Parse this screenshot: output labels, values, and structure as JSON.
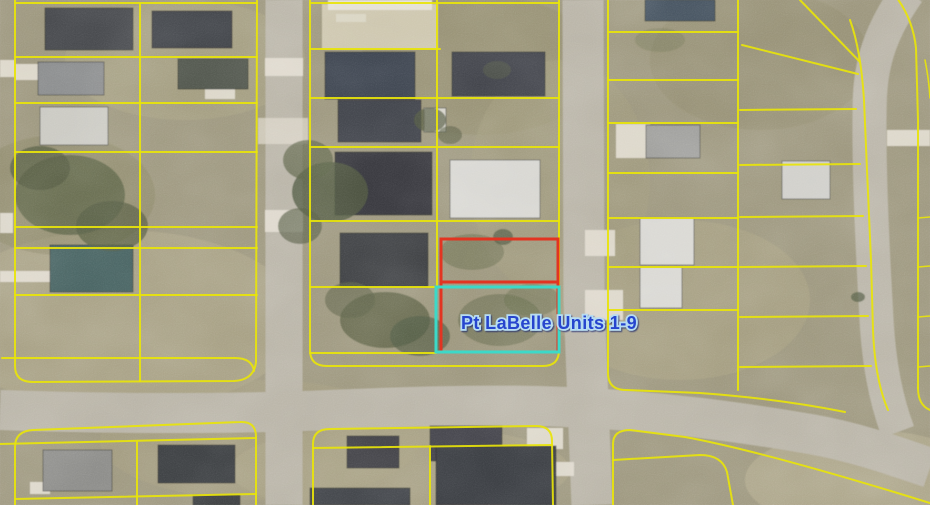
{
  "map": {
    "label": {
      "text": "Pt LaBelle Units 1-9",
      "x": 549,
      "y": 329
    },
    "colors": {
      "parcel_line_yellow": "#e8e40a",
      "highlight_red": "#e23421",
      "highlight_cyan": "#3cd9c8",
      "label_blue": "#2745ce",
      "label_halo": "#b7dcf2",
      "road_gray": "#b8b3a6",
      "ground_tan": "#9b957b",
      "driveway_light": "#ded9cc",
      "tree_olive": "#5a6146"
    },
    "highlights": [
      {
        "name": "red-outlined-lots",
        "color_ref": "highlight_red"
      },
      {
        "name": "cyan-outlined-lot",
        "color_ref": "highlight_cyan"
      }
    ],
    "features": {
      "ground_patches": [
        [
          120,
          320,
          180,
          90,
          "#b2aa8c",
          0.5
        ],
        [
          680,
          300,
          130,
          80,
          "#aca584",
          0.45
        ],
        [
          865,
          480,
          120,
          50,
          "#c0b89a",
          0.4
        ],
        [
          60,
          195,
          95,
          60,
          "#8a8566",
          0.5
        ],
        [
          480,
          65,
          120,
          70,
          "#928b6c",
          0.5
        ],
        [
          185,
          60,
          120,
          60,
          "#aaa385",
          0.45
        ],
        [
          760,
          60,
          110,
          70,
          "#8f8a6b",
          0.4
        ],
        [
          400,
          470,
          170,
          45,
          "#b1a98b",
          0.4
        ],
        [
          560,
          180,
          90,
          120,
          "#a29b7d",
          0.5
        ],
        [
          260,
          440,
          160,
          60,
          "#a8a083",
          0.4
        ]
      ],
      "bare_ground": [
        [
          322,
          4,
          116,
          45,
          "#cdc6ae",
          1
        ],
        [
          328,
          0,
          104,
          10,
          "#e3e0d4",
          1
        ],
        [
          336,
          14,
          30,
          8,
          "#dcd8c8",
          0.8
        ]
      ],
      "roads": [
        {
          "d": "M284,0 L284,505",
          "w": 37
        },
        {
          "d": "M583,0 L584,300 L592,505",
          "w": 41
        },
        {
          "d": "M0,410 C140,415 260,413 330,410 C420,406 500,404 566,407 C660,411 740,422 810,434 C856,442 895,456 930,468",
          "w": 40
        },
        {
          "d": "M908,-8 C885,25 872,55 870,95 C868,150 872,240 876,310 C878,355 884,395 898,432",
          "w": 34
        }
      ],
      "driveways": [
        [
          0,
          60,
          15,
          17
        ],
        [
          0,
          213,
          13,
          20
        ],
        [
          265,
          58,
          38,
          18
        ],
        [
          265,
          210,
          38,
          22
        ],
        [
          258,
          118,
          50,
          26,
          0.7
        ],
        [
          585,
          230,
          30,
          26
        ],
        [
          585,
          290,
          38,
          30
        ],
        [
          616,
          124,
          34,
          34
        ],
        [
          887,
          130,
          43,
          16
        ],
        [
          527,
          428,
          36,
          21
        ],
        [
          30,
          482,
          20,
          12
        ],
        [
          548,
          462,
          26,
          14
        ],
        [
          15,
          64,
          24,
          16
        ],
        [
          0,
          271,
          52,
          11
        ],
        [
          205,
          88,
          30,
          11
        ]
      ],
      "houses": [
        [
          45,
          8,
          88,
          42,
          "#45464b"
        ],
        [
          152,
          11,
          80,
          37,
          "#3d3f44"
        ],
        [
          38,
          62,
          66,
          33,
          "#87898a"
        ],
        [
          178,
          59,
          70,
          30,
          "#51564e"
        ],
        [
          40,
          107,
          68,
          38,
          "#c9c8c1"
        ],
        [
          50,
          245,
          83,
          47,
          "#44605e"
        ],
        [
          325,
          52,
          90,
          47,
          "#3b424e"
        ],
        [
          452,
          52,
          93,
          44,
          "#404249"
        ],
        [
          338,
          100,
          83,
          42,
          "#3e4046"
        ],
        [
          424,
          108,
          22,
          24,
          "#d5d3c9"
        ],
        [
          335,
          152,
          97,
          63,
          "#34353a"
        ],
        [
          450,
          160,
          90,
          58,
          "#d6d5d0"
        ],
        [
          340,
          233,
          88,
          54,
          "#3a3c41"
        ],
        [
          645,
          0,
          70,
          21,
          "#43505b"
        ],
        [
          646,
          125,
          54,
          33,
          "#9c9c99"
        ],
        [
          640,
          218,
          54,
          47,
          "#d8d7d2"
        ],
        [
          640,
          267,
          42,
          41,
          "#d8d7d2"
        ],
        [
          782,
          161,
          48,
          38,
          "#cfcec9"
        ],
        [
          43,
          450,
          69,
          41,
          "#8a8a87"
        ],
        [
          158,
          445,
          77,
          38,
          "#36373b"
        ],
        [
          193,
          495,
          47,
          10,
          "#393a3e"
        ],
        [
          347,
          436,
          52,
          32,
          "#3c3d42"
        ],
        [
          430,
          426,
          72,
          35,
          "#3f4046"
        ],
        [
          436,
          446,
          120,
          59,
          "#393a3f"
        ],
        [
          310,
          488,
          100,
          17,
          "#3e3f44"
        ]
      ],
      "trees": [
        [
          70,
          195,
          55,
          40,
          0.8,
          "#5a6146"
        ],
        [
          40,
          168,
          30,
          22,
          0.7,
          "#50573f"
        ],
        [
          112,
          226,
          36,
          25,
          0.75,
          "#555c42"
        ],
        [
          330,
          192,
          38,
          30,
          0.8,
          "#4e5840"
        ],
        [
          308,
          160,
          25,
          20,
          0.7,
          "#5a6146"
        ],
        [
          300,
          226,
          22,
          18,
          0.65,
          "#50573f"
        ],
        [
          385,
          320,
          45,
          28,
          0.75,
          "#555c42"
        ],
        [
          350,
          300,
          25,
          18,
          0.6,
          "#5a6146"
        ],
        [
          420,
          336,
          30,
          20,
          0.65,
          "#4e5840"
        ],
        [
          500,
          320,
          42,
          26,
          0.5,
          "#5f6649"
        ],
        [
          472,
          252,
          32,
          18,
          0.45,
          "#5f6649"
        ],
        [
          532,
          300,
          28,
          16,
          0.4,
          "#5f6649"
        ],
        [
          430,
          120,
          16,
          12,
          0.7,
          "#50573f"
        ],
        [
          450,
          135,
          12,
          9,
          0.6,
          "#555c42"
        ],
        [
          503,
          237,
          10,
          8,
          0.7,
          "#4e5840"
        ],
        [
          858,
          297,
          7,
          5,
          0.7,
          "#4e5840"
        ],
        [
          497,
          70,
          14,
          9,
          0.4,
          "#5f6649"
        ],
        [
          660,
          40,
          25,
          12,
          0.3,
          "#6b7050"
        ]
      ],
      "parcel_lines": [
        {
          "d": "M15,0 L15,366 Q15,382 33,382 L234,381 Q254,380 256,362 L257,0"
        },
        {
          "d": "M15,3 L257,3"
        },
        {
          "d": "M15,57 L257,57"
        },
        {
          "d": "M15,103 L257,103"
        },
        {
          "d": "M15,152 L257,152"
        },
        {
          "d": "M15,227 L257,227"
        },
        {
          "d": "M15,248 L257,248"
        },
        {
          "d": "M15,295 L257,295"
        },
        {
          "d": "M2,358 L235,358 Q252,358 254,371"
        },
        {
          "d": "M140,3 L140,381"
        },
        {
          "d": "M15,505 L15,447 Q15,431 33,430 L240,422 Q256,421 256,437 L256,505"
        },
        {
          "d": "M0,444 L256,438"
        },
        {
          "d": "M137,442 L137,505"
        },
        {
          "d": "M15,499 L256,494"
        },
        {
          "d": "M310,0 L310,350 Q310,366 327,366 L543,366 Q559,366 559,350 L559,0"
        },
        {
          "d": "M310,3 L559,3"
        },
        {
          "d": "M310,49 L440,49"
        },
        {
          "d": "M310,98 L559,98"
        },
        {
          "d": "M310,147 L559,147"
        },
        {
          "d": "M310,221 L559,221"
        },
        {
          "d": "M310,287 L437,287"
        },
        {
          "d": "M310,353 L436,353"
        },
        {
          "d": "M437,0 L437,287"
        },
        {
          "d": "M313,505 L313,444 Q313,429 330,429 L536,426 Q552,426 552,441 L553,505"
        },
        {
          "d": "M313,448 L552,445"
        },
        {
          "d": "M430,446 L430,505"
        },
        {
          "d": "M608,0 L608,373 Q608,390 626,390 L700,393 C755,397 800,403 845,412"
        },
        {
          "d": "M738,0 L738,390"
        },
        {
          "d": "M608,32 L738,32"
        },
        {
          "d": "M608,80 L738,80"
        },
        {
          "d": "M608,123 L738,123"
        },
        {
          "d": "M608,173 L738,173"
        },
        {
          "d": "M608,218 L738,218"
        },
        {
          "d": "M608,267 L738,267"
        },
        {
          "d": "M608,310 L738,310"
        },
        {
          "d": "M740,110 L856,109"
        },
        {
          "d": "M740,165 L860,164"
        },
        {
          "d": "M740,217 L863,216"
        },
        {
          "d": "M740,267 L866,266"
        },
        {
          "d": "M740,317 L868,316"
        },
        {
          "d": "M740,367 L871,366"
        },
        {
          "d": "M742,45 L858,74"
        },
        {
          "d": "M800,0 L860,62"
        },
        {
          "d": "M850,20 C858,42 862,68 864,100 L867,170 L871,260 L873,330 Q875,380 888,410"
        },
        {
          "d": "M897,-2 Q913,20 916,48 L918,120 L918,388"
        },
        {
          "d": "M925,60 Q929,80 930,98",
          "w": 1.6
        },
        {
          "d": "M918,218 L930,217",
          "w": 1.6
        },
        {
          "d": "M918,267 L930,266",
          "w": 1.6
        },
        {
          "d": "M918,317 L930,316",
          "w": 1.6
        },
        {
          "d": "M918,367 L930,366",
          "w": 1.6
        },
        {
          "d": "M918,388 Q918,405 930,410"
        },
        {
          "d": "M613,505 L613,444 Q613,430 630,430 L685,437 C745,448 830,472 930,503"
        },
        {
          "d": "M613,460 L700,455 Q722,455 727,472 L733,505"
        }
      ],
      "highlight_red": {
        "rects": [
          [
            441,
            239,
            117,
            43
          ],
          [
            441,
            282,
            117,
            70
          ]
        ]
      },
      "highlight_cyan": {
        "rect": [
          436,
          287,
          123,
          65
        ]
      }
    }
  }
}
